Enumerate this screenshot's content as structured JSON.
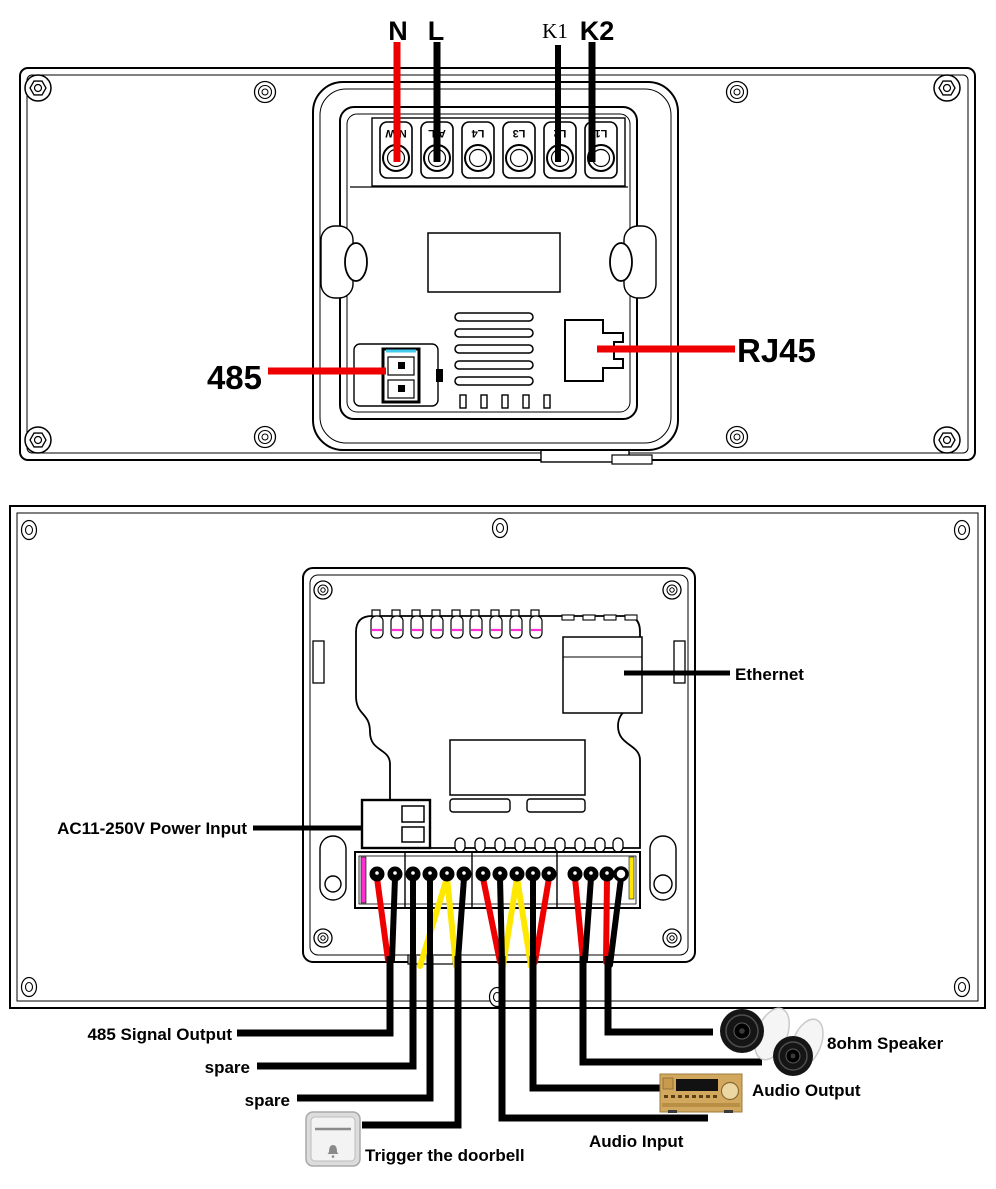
{
  "colors": {
    "red": "#ee0000",
    "yellow": "#ffe800",
    "magenta": "#ff2fd4",
    "cyan": "#44ccee",
    "black": "#000000"
  },
  "top_diagram": {
    "wire_labels": {
      "n": "N",
      "l": "L",
      "k1": "K1",
      "k2": "K2"
    },
    "terminal_labels": [
      "N/W",
      "A/L",
      "L4",
      "L3",
      "L2",
      "L1"
    ],
    "callouts": {
      "rs485": "485",
      "rj45": "RJ45"
    }
  },
  "bottom_diagram": {
    "callouts": {
      "ethernet": "Ethernet",
      "power": "AC11-250V Power Input",
      "signal_485": "485 Signal Output",
      "spare1": "spare",
      "spare2": "spare",
      "doorbell": "Trigger the doorbell",
      "audio_in": "Audio Input",
      "audio_out": "Audio Output",
      "speaker": "8ohm Speaker"
    }
  }
}
